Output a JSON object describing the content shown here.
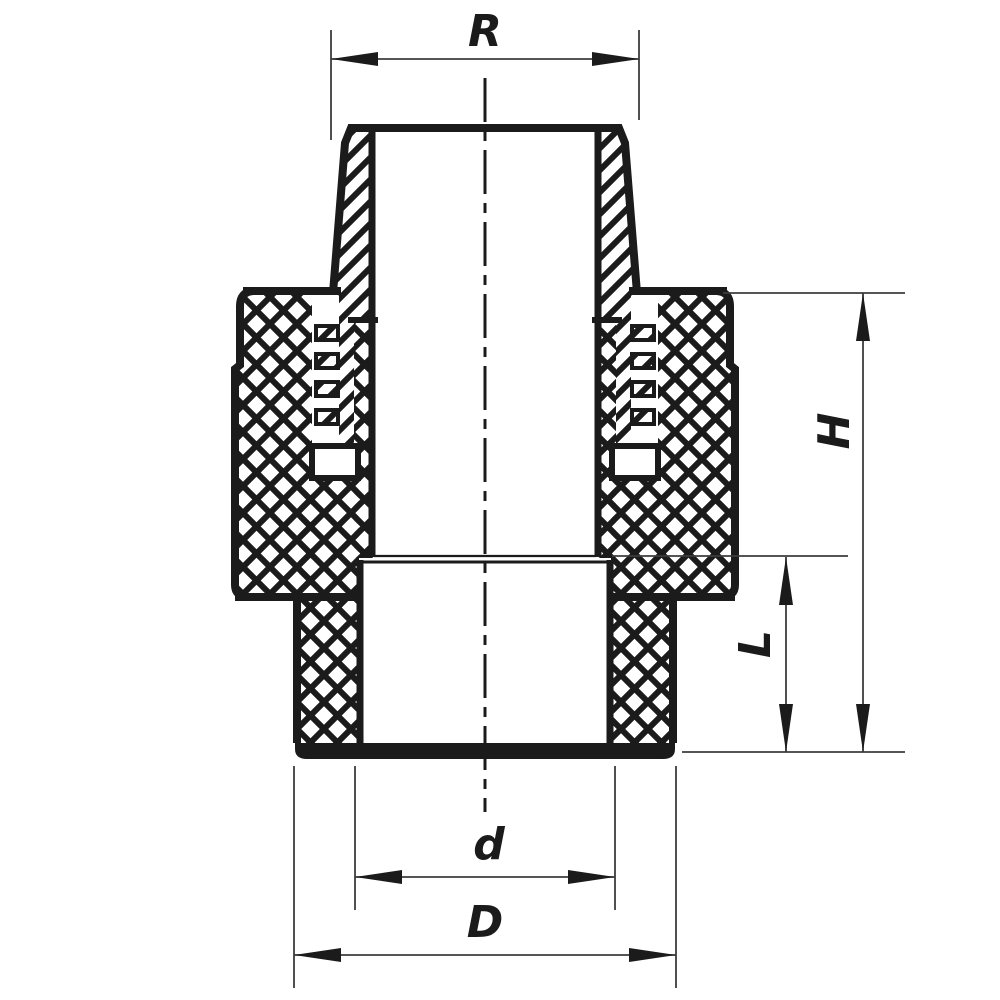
{
  "background": "#ffffff",
  "colors": {
    "outline": "#1b1b1b",
    "dimension_lines": "#3d3d3d"
  },
  "drawing": {
    "kind": "cross-section",
    "hatch_styles": {
      "male_thread_adapter": "diagonal",
      "nut_and_body": "cross-hatch"
    }
  },
  "dimensions": {
    "top_thread": {
      "label": "R"
    },
    "overall_height": {
      "label": "H"
    },
    "socket_depth": {
      "label": "L"
    },
    "inner_diameter": {
      "label": "d"
    },
    "outer_diameter": {
      "label": "D"
    }
  }
}
